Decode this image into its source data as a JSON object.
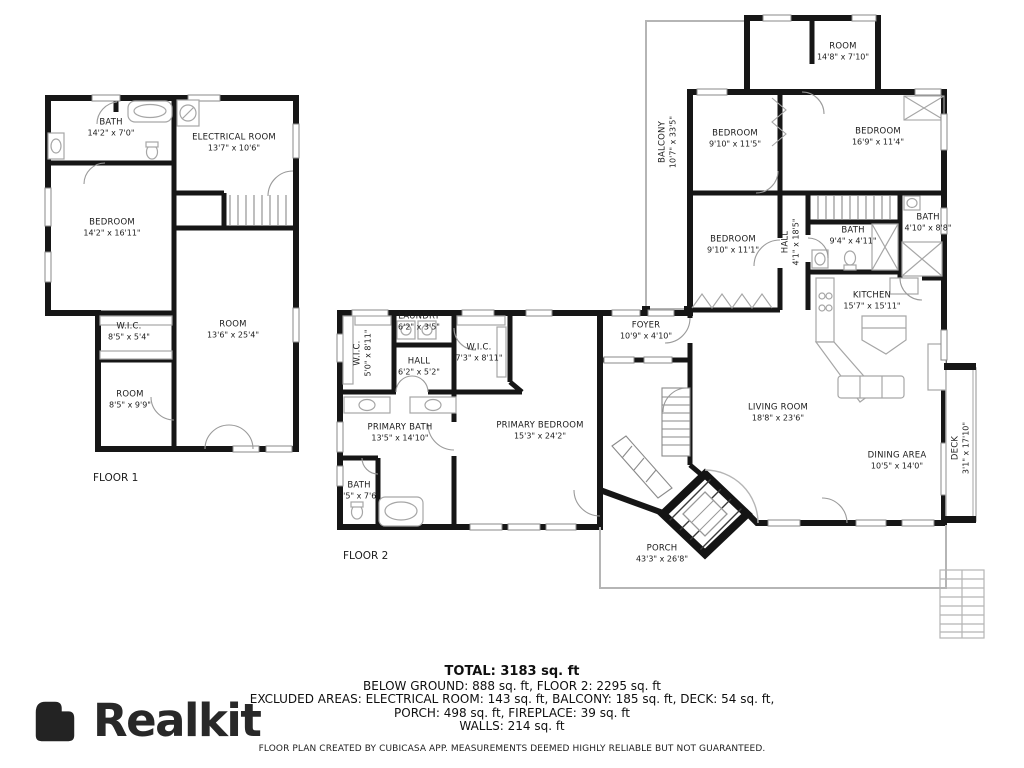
{
  "branding": {
    "logo_text": "Realkit"
  },
  "floors": [
    {
      "caption": "FLOOR 1"
    },
    {
      "caption": "FLOOR 2"
    }
  ],
  "rooms": [
    {
      "id": "bath-f1",
      "name": "BATH",
      "dims": "14'2\" x 7'0\""
    },
    {
      "id": "electrical-room",
      "name": "ELECTRICAL ROOM",
      "dims": "13'7\" x 10'6\""
    },
    {
      "id": "bedroom-f1",
      "name": "BEDROOM",
      "dims": "14'2\" x 16'11\""
    },
    {
      "id": "wic-f1",
      "name": "W.I.C.",
      "dims": "8'5\" x 5'4\""
    },
    {
      "id": "room-f1-large",
      "name": "ROOM",
      "dims": "13'6\" x 25'4\""
    },
    {
      "id": "room-f1-small",
      "name": "ROOM",
      "dims": "8'5\" x 9'9\""
    },
    {
      "id": "laundry",
      "name": "LAUNDRY",
      "dims": "6'2\" x 3'5\""
    },
    {
      "id": "wic-f2-left",
      "name": "W.I.C.",
      "dims": "5'0\" x 8'11\""
    },
    {
      "id": "hall-f2",
      "name": "HALL",
      "dims": "6'2\" x 5'2\""
    },
    {
      "id": "wic-f2-right",
      "name": "W.I.C.",
      "dims": "7'3\" x 8'11\""
    },
    {
      "id": "primary-bath",
      "name": "PRIMARY BATH",
      "dims": "13'5\" x 14'10\""
    },
    {
      "id": "primary-bedroom",
      "name": "PRIMARY BEDROOM",
      "dims": "15'3\" x 24'2\""
    },
    {
      "id": "bath-f2-small",
      "name": "BATH",
      "dims": "3'5\" x 7'6\""
    },
    {
      "id": "room-top",
      "name": "ROOM",
      "dims": "14'8\" x 7'10\""
    },
    {
      "id": "balcony",
      "name": "BALCONY",
      "dims": "10'7\" x 33'5\""
    },
    {
      "id": "bedroom-a",
      "name": "BEDROOM",
      "dims": "9'10\" x 11'5\""
    },
    {
      "id": "bedroom-b",
      "name": "BEDROOM",
      "dims": "16'9\" x 11'4\""
    },
    {
      "id": "bedroom-c",
      "name": "BEDROOM",
      "dims": "9'10\" x 11'1\""
    },
    {
      "id": "hall-main",
      "name": "HALL",
      "dims": "4'1\" x 18'5\""
    },
    {
      "id": "bath-main-1",
      "name": "BATH",
      "dims": "9'4\" x 4'11\""
    },
    {
      "id": "bath-main-2",
      "name": "BATH",
      "dims": "4'10\" x 8'8\""
    },
    {
      "id": "kitchen",
      "name": "KITCHEN",
      "dims": "15'7\" x 15'11\""
    },
    {
      "id": "foyer",
      "name": "FOYER",
      "dims": "10'9\" x 4'10\""
    },
    {
      "id": "living-room",
      "name": "LIVING ROOM",
      "dims": "18'8\" x 23'6\""
    },
    {
      "id": "dining-area",
      "name": "DINING AREA",
      "dims": "10'5\" x 14'0\""
    },
    {
      "id": "deck",
      "name": "DECK",
      "dims": "3'1\" x 17'10\""
    },
    {
      "id": "porch",
      "name": "PORCH",
      "dims": "43'3\" x 26'8\""
    }
  ],
  "summary": {
    "total": "TOTAL: 3183 sq. ft",
    "line2": "BELOW GROUND: 888 sq. ft, FLOOR 2: 2295 sq. ft",
    "line3": "EXCLUDED AREAS: ELECTRICAL ROOM: 143 sq. ft, BALCONY: 185 sq. ft, DECK: 54 sq. ft,",
    "line4": "PORCH: 498 sq. ft, FIREPLACE: 39 sq. ft",
    "line5": "WALLS: 214 sq. ft",
    "disclaimer": "FLOOR PLAN CREATED BY CUBICASA APP. MEASUREMENTS DEEMED HIGHLY RELIABLE BUT NOT GUARANTEED."
  },
  "colors": {
    "walls": "#161616",
    "fixtures": "#a6a6a6",
    "light_outline": "#b5b5b5",
    "text": "#1b1b1b"
  }
}
